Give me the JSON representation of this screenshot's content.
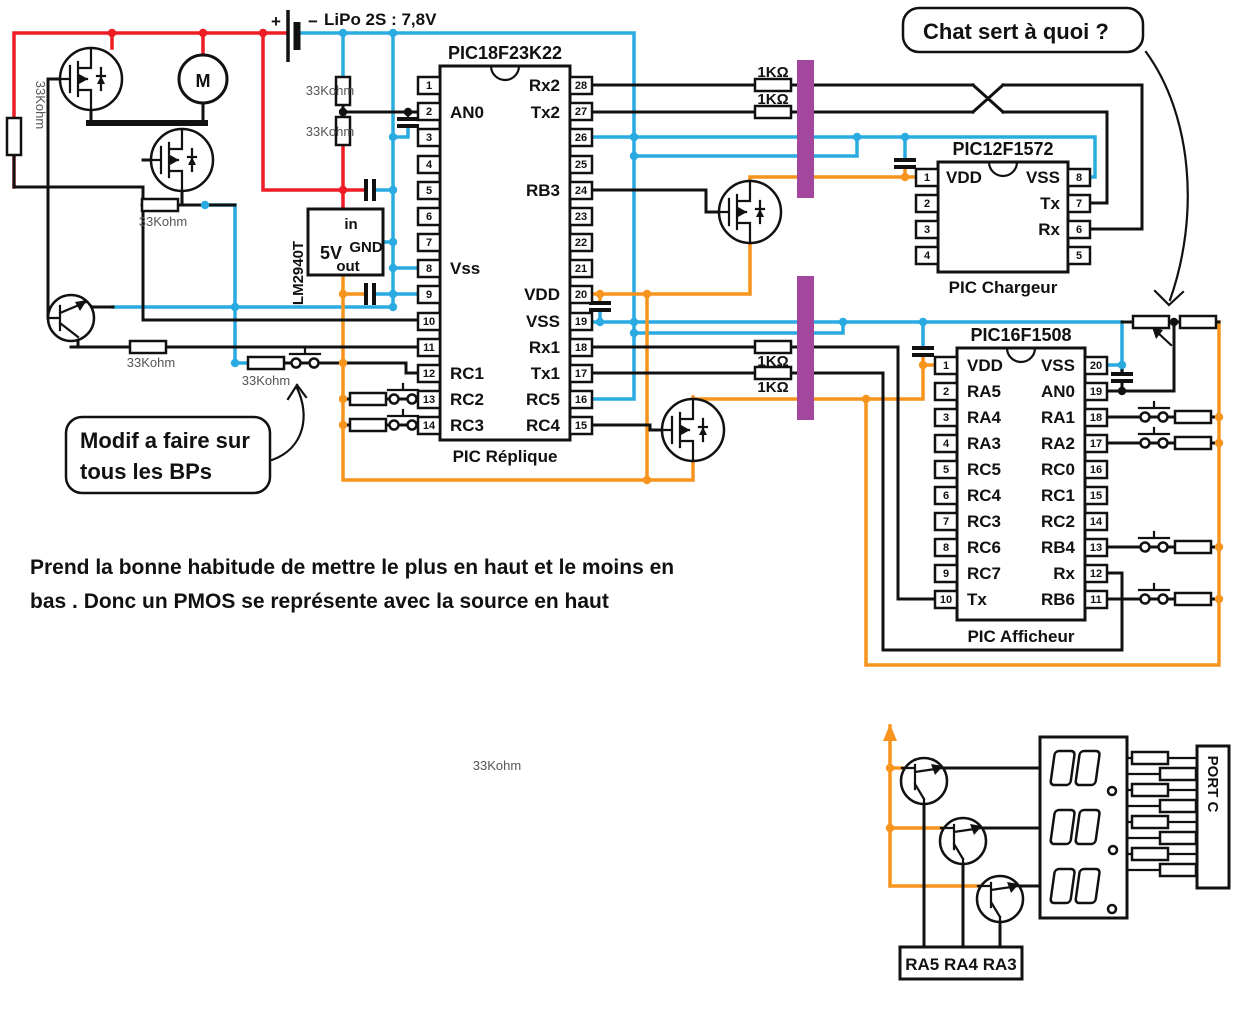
{
  "colors": {
    "wire_black": "#111111",
    "wire_red": "#ee1c25",
    "wire_blue": "#29abe2",
    "wire_orange": "#f7941d",
    "barrier_purple": "#a3479e"
  },
  "battery": {
    "plus": "+",
    "minus": "−",
    "label": "LiPo 2S : 7,8V"
  },
  "regulator": {
    "name": "LM2940T",
    "pin_in": "in",
    "output_voltage": "5V",
    "pin_gnd": "GND",
    "pin_out": "out"
  },
  "motor": {
    "label": "M"
  },
  "labels": {
    "r33k": "33Kohm",
    "r1k": "1KΩ"
  },
  "chips": {
    "pic18": {
      "title": "PIC18F23K22",
      "subtitle": "PIC Réplique",
      "left": [
        {
          "n": "1",
          "l": ""
        },
        {
          "n": "2",
          "l": "AN0"
        },
        {
          "n": "3",
          "l": ""
        },
        {
          "n": "4",
          "l": ""
        },
        {
          "n": "5",
          "l": ""
        },
        {
          "n": "6",
          "l": ""
        },
        {
          "n": "7",
          "l": ""
        },
        {
          "n": "8",
          "l": "Vss"
        },
        {
          "n": "9",
          "l": ""
        },
        {
          "n": "10",
          "l": ""
        },
        {
          "n": "11",
          "l": ""
        },
        {
          "n": "12",
          "l": "RC1"
        },
        {
          "n": "13",
          "l": "RC2"
        },
        {
          "n": "14",
          "l": "RC3"
        }
      ],
      "right": [
        {
          "n": "28",
          "l": "Rx2"
        },
        {
          "n": "27",
          "l": "Tx2"
        },
        {
          "n": "26",
          "l": ""
        },
        {
          "n": "25",
          "l": ""
        },
        {
          "n": "24",
          "l": "RB3"
        },
        {
          "n": "23",
          "l": ""
        },
        {
          "n": "22",
          "l": ""
        },
        {
          "n": "21",
          "l": ""
        },
        {
          "n": "20",
          "l": "VDD"
        },
        {
          "n": "19",
          "l": "VSS"
        },
        {
          "n": "18",
          "l": "Rx1"
        },
        {
          "n": "17",
          "l": "Tx1"
        },
        {
          "n": "16",
          "l": "RC5"
        },
        {
          "n": "15",
          "l": "RC4"
        }
      ]
    },
    "pic12": {
      "title": "PIC12F1572",
      "subtitle": "PIC Chargeur",
      "left": [
        {
          "n": "1",
          "l": "VDD"
        },
        {
          "n": "2",
          "l": ""
        },
        {
          "n": "3",
          "l": ""
        },
        {
          "n": "4",
          "l": ""
        }
      ],
      "right": [
        {
          "n": "8",
          "l": "VSS"
        },
        {
          "n": "7",
          "l": "Tx"
        },
        {
          "n": "6",
          "l": "Rx"
        },
        {
          "n": "5",
          "l": ""
        }
      ]
    },
    "pic16": {
      "title": "PIC16F1508",
      "subtitle": "PIC Afficheur",
      "left": [
        {
          "n": "1",
          "l": "VDD"
        },
        {
          "n": "2",
          "l": "RA5"
        },
        {
          "n": "3",
          "l": "RA4"
        },
        {
          "n": "4",
          "l": "RA3"
        },
        {
          "n": "5",
          "l": "RC5"
        },
        {
          "n": "6",
          "l": "RC4"
        },
        {
          "n": "7",
          "l": "RC3"
        },
        {
          "n": "8",
          "l": "RC6"
        },
        {
          "n": "9",
          "l": "RC7"
        },
        {
          "n": "10",
          "l": "Tx"
        }
      ],
      "right": [
        {
          "n": "20",
          "l": "VSS"
        },
        {
          "n": "19",
          "l": "AN0"
        },
        {
          "n": "18",
          "l": "RA1"
        },
        {
          "n": "17",
          "l": "RA2"
        },
        {
          "n": "16",
          "l": "RC0"
        },
        {
          "n": "15",
          "l": "RC1"
        },
        {
          "n": "14",
          "l": "RC2"
        },
        {
          "n": "13",
          "l": "RB4"
        },
        {
          "n": "12",
          "l": "Rx"
        },
        {
          "n": "11",
          "l": "RB6"
        }
      ]
    }
  },
  "annotations": {
    "chat_bubble": "Chat sert à quoi ?",
    "modif_bubble_line1": "Modif a faire sur",
    "modif_bubble_line2": "tous les BPs",
    "note_line1": "Prend la bonne habitude de mettre le plus en haut et le moins en",
    "note_line2": "bas . Donc un PMOS se représente avec la source en haut"
  },
  "display_section": {
    "port": "PORT C",
    "driver_pins": "RA5 RA4 RA3"
  }
}
